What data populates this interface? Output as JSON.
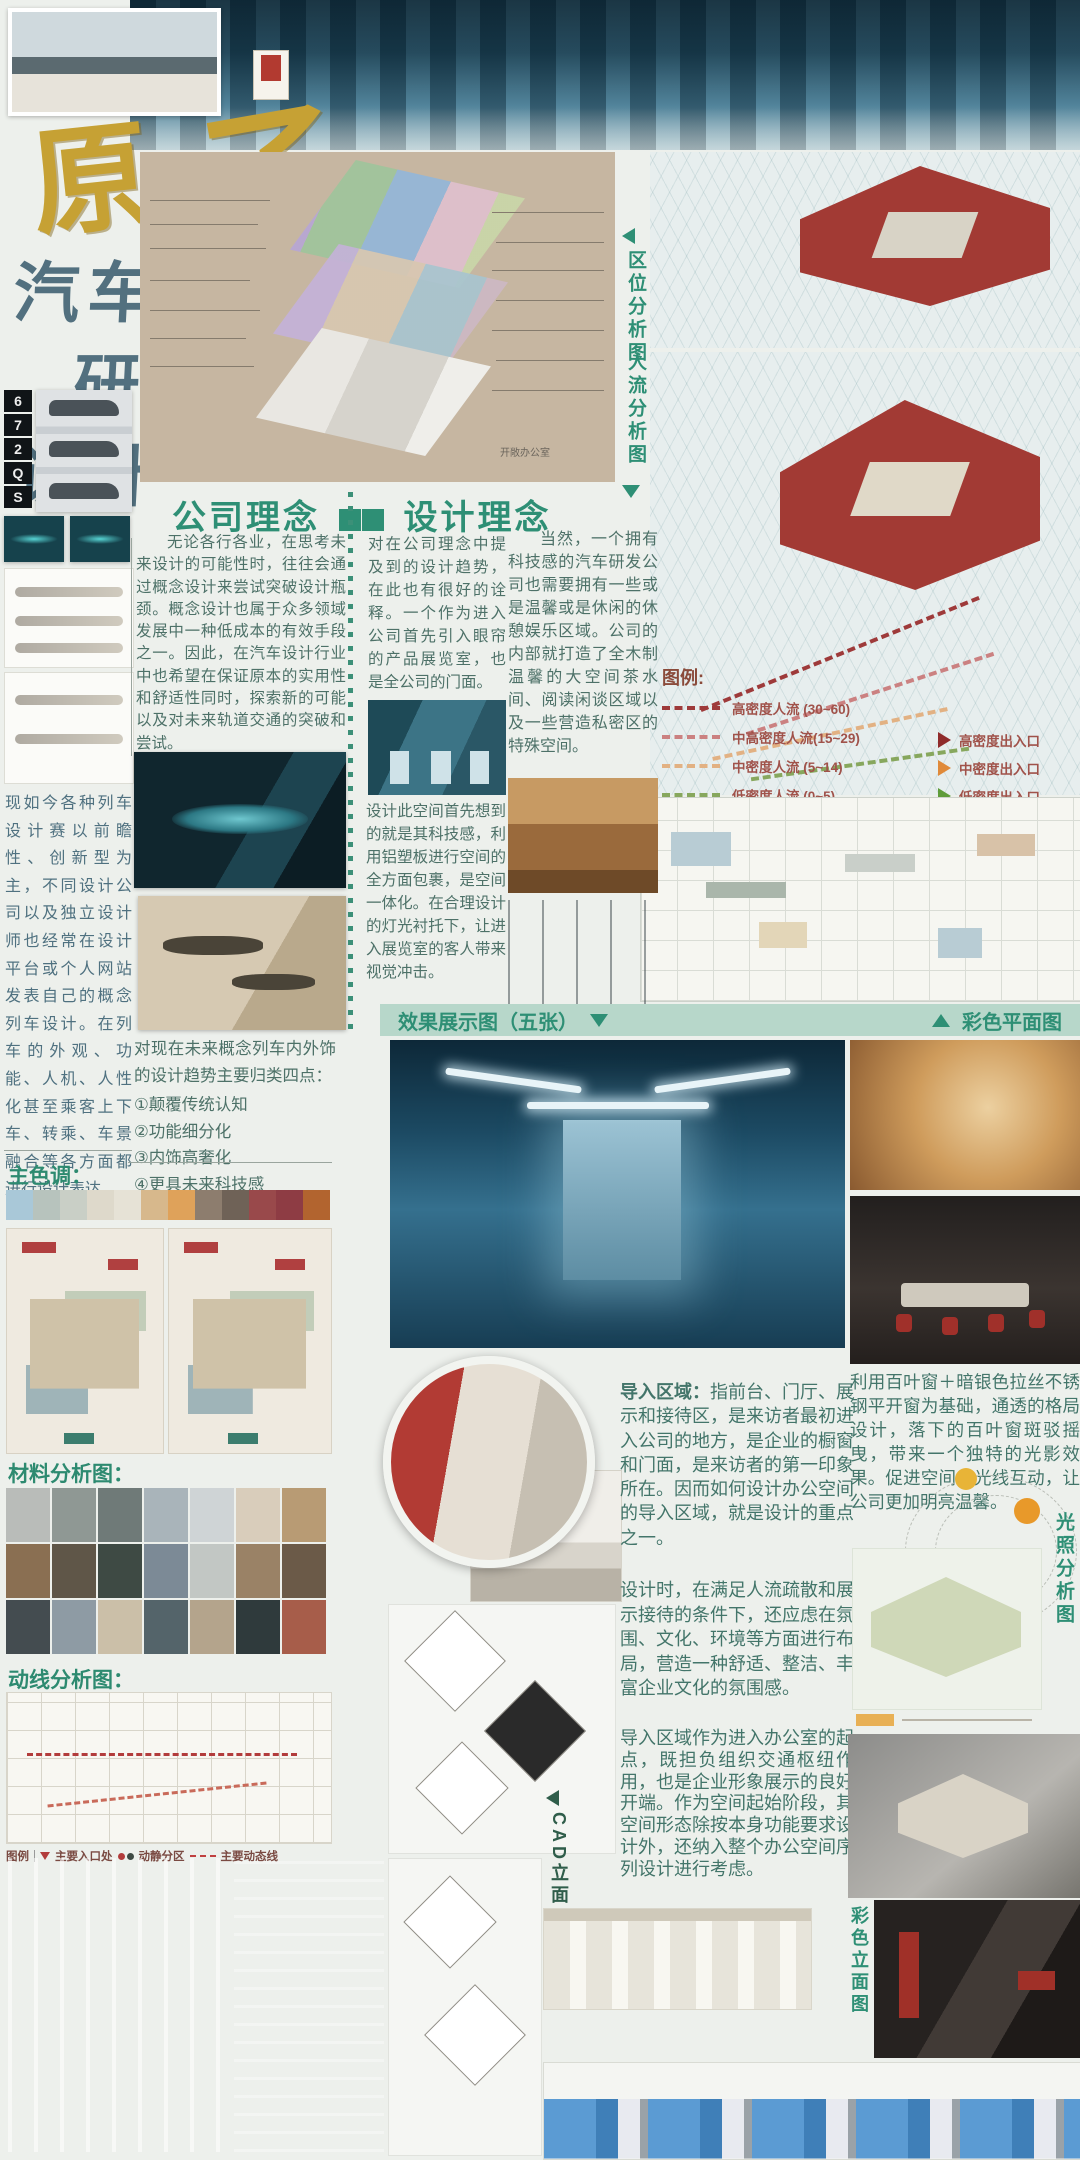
{
  "poster": {
    "brand": {
      "calligraphy_1": "原",
      "calligraphy_2": "子",
      "titles": [
        "汽车",
        "研发",
        "设计"
      ],
      "side_letters": [
        "6",
        "7",
        "2",
        "Q",
        "S"
      ]
    },
    "analysis_labels": {
      "location": "区位分析图",
      "flow": "人流分析图",
      "light": "光照分析图",
      "cad_elevation": "CAD立面图",
      "color_elevation": "彩色立面图",
      "color_plan": "彩色平面图",
      "effects": "效果展示图（五张）"
    },
    "section_headings": {
      "company": "公司理念",
      "design": "设计理念",
      "main_colors": "主色调：",
      "materials": "材料分析图：",
      "circulation": "动线分析图："
    },
    "texts": {
      "company_body": "无论各行各业，在思考未来设计的可能性时，往往会通过概念设计来尝试突破设计瓶颈。概念设计也属于众多领域发展中一种低成本的有效手段之一。因此，在汽车设计行业中也希望在保证原本的实用性和舒适性同时，探索新的可能以及对未来轨道交通的突破和尝试。",
      "left_intro": "现如今各种列车设计赛以前瞻性、创新型为主，不同设计公司以及独立设计师也经常在设计平台或个人网站发表自己的概念列车设计。在列车的外观、功能、人机、人性化甚至乘客上下车、转乘、车景融合等各方面都进行设计表达。",
      "design_col1a": "对在公司理念中提及到的设计趋势，在此也有很好的诠释。一个作为进入公司首先引入眼帘的产品展览室，也是全公司的门面。",
      "design_col1b": "设计此空间首先想到的就是其科技感，利用铝塑板进行空间的全方面包裹，是空间一体化。在合理设计的灯光衬托下，让进入展览室的客人带来视觉冲击。",
      "design_col2": "当然，一个拥有科技感的汽车研发公司也需要拥有一些或是温馨或是休闲的休憩娱乐区域。公司的内部就打造了全木制温馨的大空间茶水间、阅读闲谈区域以及一些营造私密区的特殊空间。",
      "trends_intro": "对现在未来概念列车内外饰的设计趋势主要归类四点：",
      "trend_items": [
        "①颠覆传统认知",
        "②功能细分化",
        "③内饰高奢化",
        "④更具未来科技感"
      ],
      "entry_lead": "导入区域：",
      "entry_body": "指前台、门厅、展示和接待区，是来访者最初进入公司的地方，是企业的橱窗和门面，是来访者的第一印象所在。因而如何设计办公空间的导入区域，就是设计的重点之一。",
      "design_time": "设计时，在满足人流疏散和展示接待的条件下，还应虑在氛围、文化、环境等方面进行布局，营造一种舒适、整洁、丰富企业文化的氛围感。",
      "entry_role": "导入区域作为进入办公室的起点，既担负组织交通枢纽作用，也是企业形象展示的良好开端。作为空间起始阶段，其空间形态除按本身功能要求设计外，还纳入整个办公空间序列设计进行考虑。",
      "louver": "利用百叶窗＋暗银色拉丝不锈钢平开窗为基础，通透的格局设计，落下的百叶窗斑驳摇曳，带来一个独特的光影效果。促进空间内光线互动，让公司更加明亮温馨。",
      "axon_room_label": "开敞办公室"
    },
    "flow_legend": {
      "title": "图例:",
      "flows": [
        {
          "label": "高密度人流",
          "range": "(30~60)",
          "color": "#9e3a3a"
        },
        {
          "label": "中高密度人流",
          "range": "(15~29)",
          "color": "#cb8181"
        },
        {
          "label": "中密度人流",
          "range": "(5~14)",
          "color": "#e2b183"
        },
        {
          "label": "低密度人流",
          "range": "(0~5)",
          "color": "#87a75d"
        }
      ],
      "entrances": [
        {
          "label": "高密度出入口",
          "color": "#8f2b2b"
        },
        {
          "label": "中密度出入口",
          "color": "#e08a3a"
        },
        {
          "label": "低密度出入口",
          "color": "#5f9c3a"
        }
      ]
    },
    "circulation_legend": {
      "title": "图例",
      "items": [
        "主要入口处",
        "动静分区",
        "主要动态线"
      ]
    },
    "palette": [
      "#a9c8d8",
      "#b7c3bd",
      "#c9cfc6",
      "#ded9cb",
      "#e6e2d6",
      "#d7b88c",
      "#dfa25a",
      "#8d7d6e",
      "#6f6257",
      "#99494b",
      "#8e3c44",
      "#b2642f"
    ],
    "materials": [
      "#b9bcb9",
      "#8f9894",
      "#6f7a78",
      "#a9b4ba",
      "#cfd4d6",
      "#d9cdbb",
      "#b89b74",
      "#8a6f52",
      "#5f5648",
      "#3e4a44",
      "#7c8a96",
      "#c2c7c4",
      "#9a8266",
      "#6b5a48",
      "#444c50",
      "#8e9ba4",
      "#cbbfa8",
      "#54646a",
      "#b4a48c",
      "#2f3a3c",
      "#a75d4a"
    ],
    "colors": {
      "accent_green": "#2e8f75",
      "banner_bg": "#b7d7ca",
      "gold": "#c6a134",
      "title_blue": "#52707f"
    }
  }
}
